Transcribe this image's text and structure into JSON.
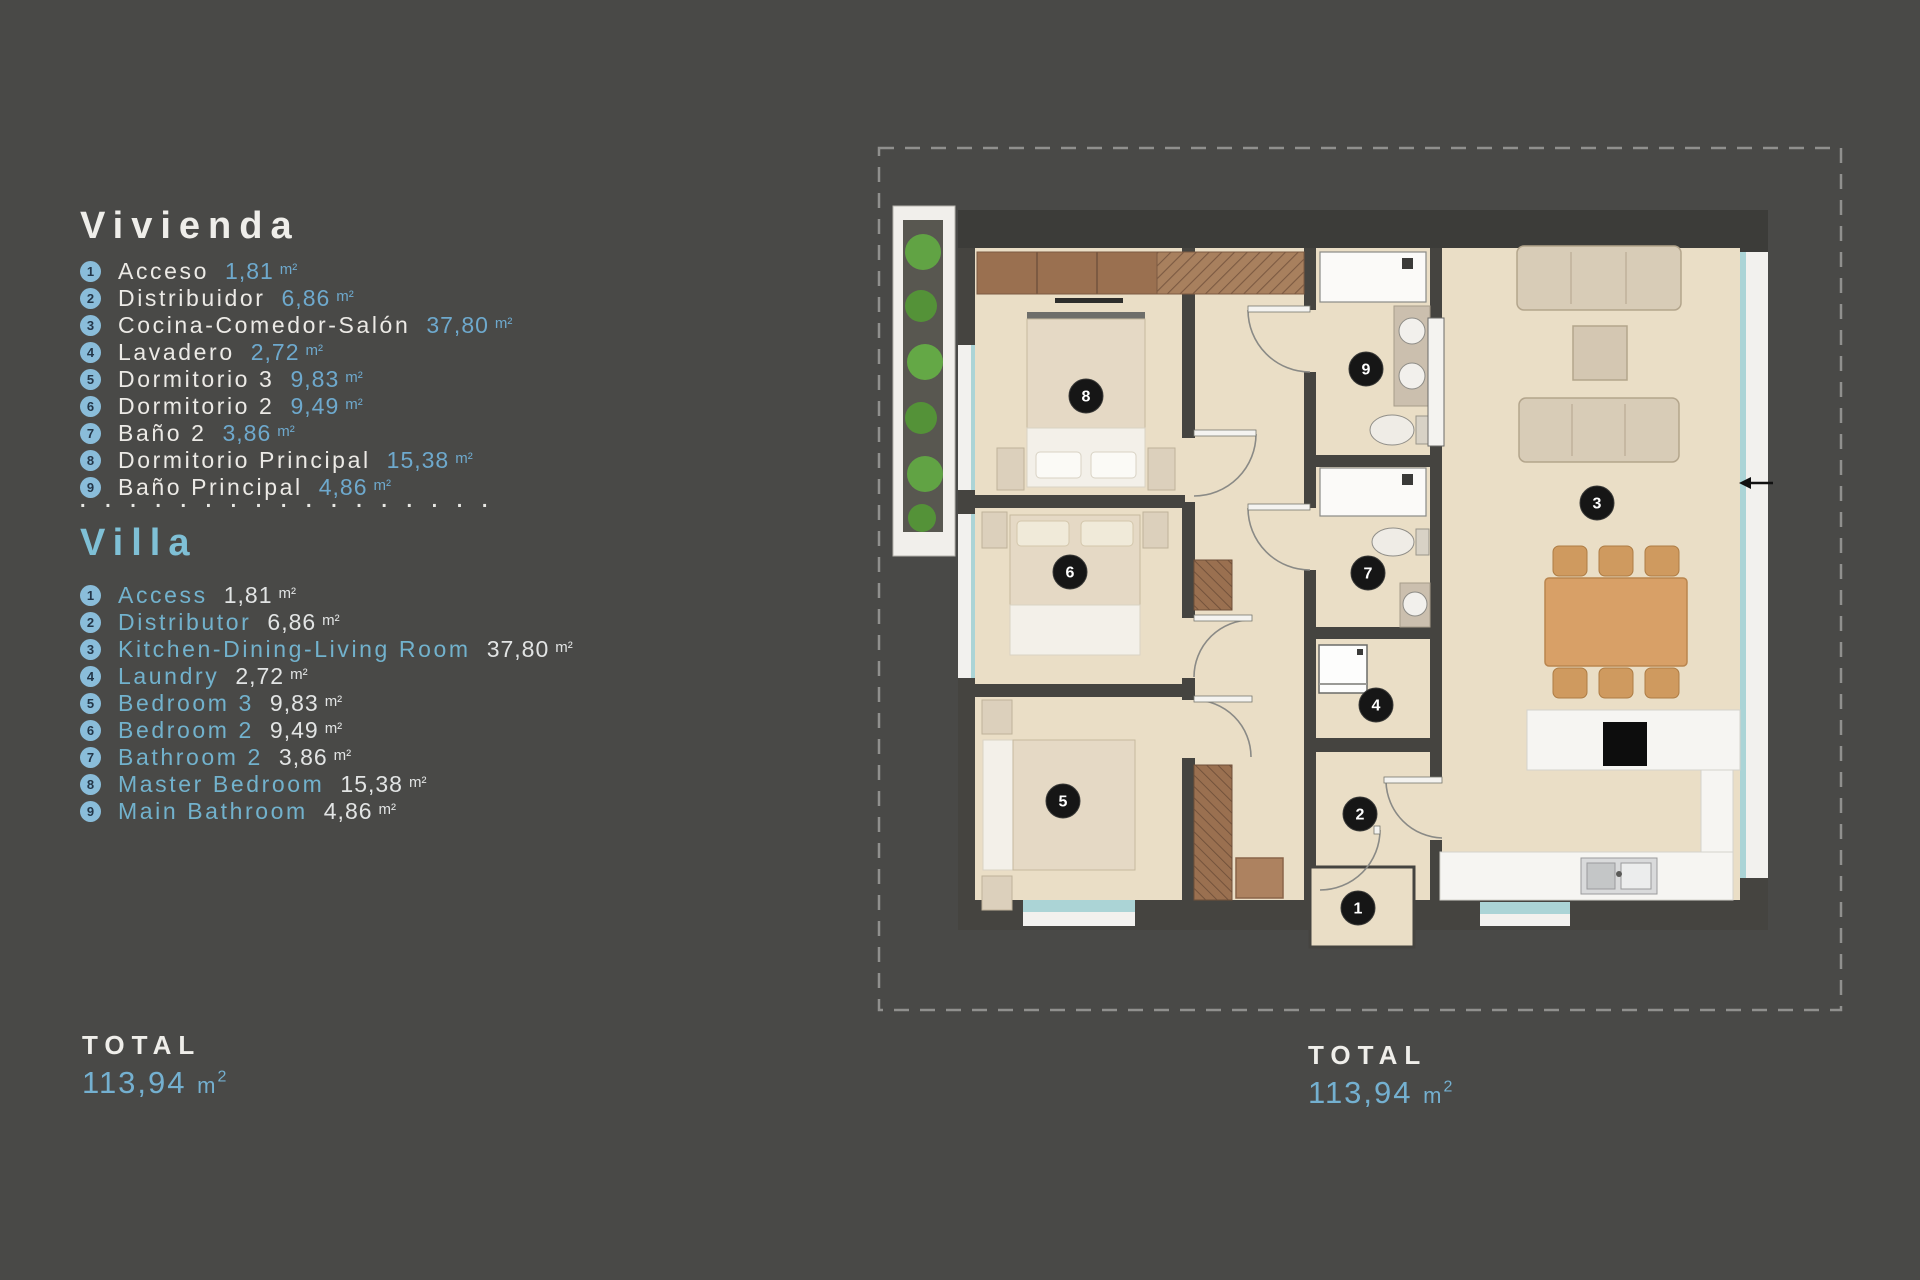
{
  "colors": {
    "background": "#494947",
    "accent_blue": "#6ea9cd",
    "villa_blue": "#7fc0d6",
    "badge_blue": "#8abdda",
    "marker_black": "#161616",
    "floor_beige": "#eadec6",
    "wall_dark": "#454440",
    "wood_brown": "#9a7050",
    "table_wood": "#d8a067",
    "garden_green": "#5c9a3c",
    "window_teal": "#abd4d6"
  },
  "legend": {
    "vivienda": {
      "title": "Vivienda",
      "items": [
        {
          "n": "1",
          "name": "Acceso",
          "area": "1,81",
          "unit": "m²"
        },
        {
          "n": "2",
          "name": "Distribuidor",
          "area": "6,86",
          "unit": "m²"
        },
        {
          "n": "3",
          "name": "Cocina-Comedor-Salón",
          "area": "37,80",
          "unit": "m²"
        },
        {
          "n": "4",
          "name": "Lavadero",
          "area": "2,72",
          "unit": "m²"
        },
        {
          "n": "5",
          "name": "Dormitorio 3",
          "area": "9,83",
          "unit": "m²"
        },
        {
          "n": "6",
          "name": "Dormitorio 2",
          "area": "9,49",
          "unit": "m²"
        },
        {
          "n": "7",
          "name": "Baño 2",
          "area": "3,86",
          "unit": "m²"
        },
        {
          "n": "8",
          "name": "Dormitorio Principal",
          "area": "15,38",
          "unit": "m²"
        },
        {
          "n": "9",
          "name": "Baño Principal",
          "area": "4,86",
          "unit": "m²"
        }
      ]
    },
    "separator": ". . . . . . . . . . . . . . . . .",
    "villa": {
      "title": "Villa",
      "items": [
        {
          "n": "1",
          "name": "Access",
          "area": "1,81",
          "unit": "m²"
        },
        {
          "n": "2",
          "name": "Distributor",
          "area": "6,86",
          "unit": "m²"
        },
        {
          "n": "3",
          "name": "Kitchen-Dining-Living Room",
          "area": "37,80",
          "unit": "m²"
        },
        {
          "n": "4",
          "name": "Laundry",
          "area": "2,72",
          "unit": "m²"
        },
        {
          "n": "5",
          "name": "Bedroom 3",
          "area": "9,83",
          "unit": "m²"
        },
        {
          "n": "6",
          "name": "Bedroom 2",
          "area": "9,49",
          "unit": "m²"
        },
        {
          "n": "7",
          "name": "Bathroom 2",
          "area": "3,86",
          "unit": "m²"
        },
        {
          "n": "8",
          "name": "Master Bedroom",
          "area": "15,38",
          "unit": "m²"
        },
        {
          "n": "9",
          "name": "Main Bathroom",
          "area": "4,86",
          "unit": "m²"
        }
      ]
    },
    "total_label": "TOTAL",
    "total_value": "113,94",
    "total_unit_base": "m",
    "total_unit_sup": "2"
  },
  "plan": {
    "total_label": "TOTAL",
    "total_value": "113,94",
    "total_unit_base": "m",
    "total_unit_sup": "2",
    "markers": [
      {
        "n": "1",
        "x": 483,
        "y": 768
      },
      {
        "n": "2",
        "x": 485,
        "y": 674
      },
      {
        "n": "3",
        "x": 722,
        "y": 363
      },
      {
        "n": "4",
        "x": 501,
        "y": 565
      },
      {
        "n": "5",
        "x": 188,
        "y": 661
      },
      {
        "n": "6",
        "x": 195,
        "y": 432
      },
      {
        "n": "7",
        "x": 493,
        "y": 433
      },
      {
        "n": "8",
        "x": 211,
        "y": 256
      },
      {
        "n": "9",
        "x": 491,
        "y": 229
      }
    ]
  }
}
